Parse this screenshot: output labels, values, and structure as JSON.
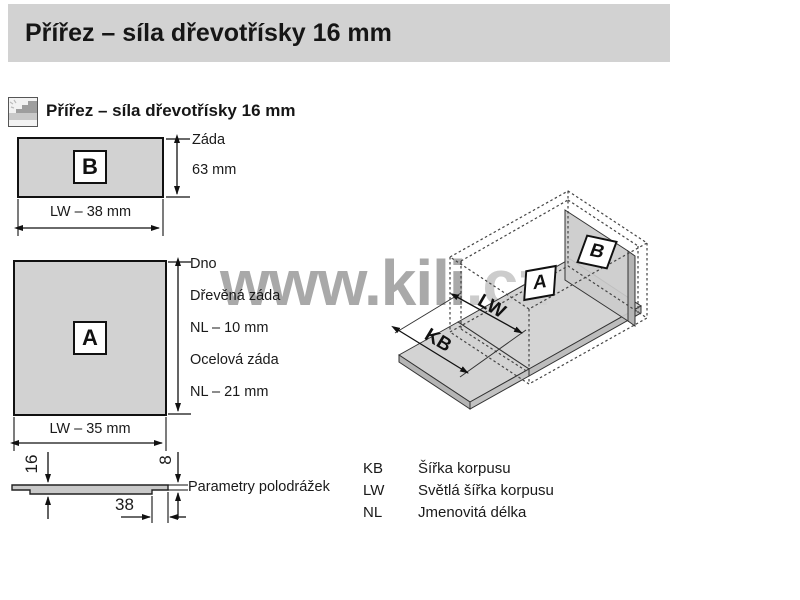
{
  "header": {
    "title": "Přířez – síla dřevotřísky 16 mm"
  },
  "section": {
    "title": "Přířez – síla dřevotřísky 16 mm",
    "icon": "chipboard-icon"
  },
  "panel_b": {
    "label": "B",
    "height_label_line1": "Záda",
    "height_label_line2": "63 mm",
    "width_label": "LW – 38 mm"
  },
  "panel_a": {
    "label": "A",
    "side_labels": [
      "Dno",
      "Dřevěná záda",
      "NL – 10 mm",
      "Ocelová záda",
      "NL – 21 mm"
    ],
    "width_label": "LW – 35 mm"
  },
  "profile": {
    "thickness_dim": "16",
    "rabbet_thickness_dim": "8",
    "rabbet_width_dim": "38",
    "label": "Parametry polodrážek"
  },
  "iso": {
    "label_a": "A",
    "label_b": "B",
    "inner_width_dim": "LW",
    "body_width_dim": "KB"
  },
  "legend": {
    "rows": [
      {
        "abbr": "KB",
        "desc": "Šířka korpusu"
      },
      {
        "abbr": "LW",
        "desc": "Světlá šířka korpusu"
      },
      {
        "abbr": "NL",
        "desc": "Jmenovitá délka"
      }
    ]
  },
  "watermark": {
    "main": "www.kili",
    "suffix": ".cz"
  },
  "colors": {
    "header_bg": "#d2d2d2",
    "panel_fill": "#d2d2d2",
    "iso_panel_fill": "#d0d0d0",
    "outline": "#1a1a1a",
    "watermark": "#a9a9a9",
    "watermark_light": "#cccccc"
  }
}
